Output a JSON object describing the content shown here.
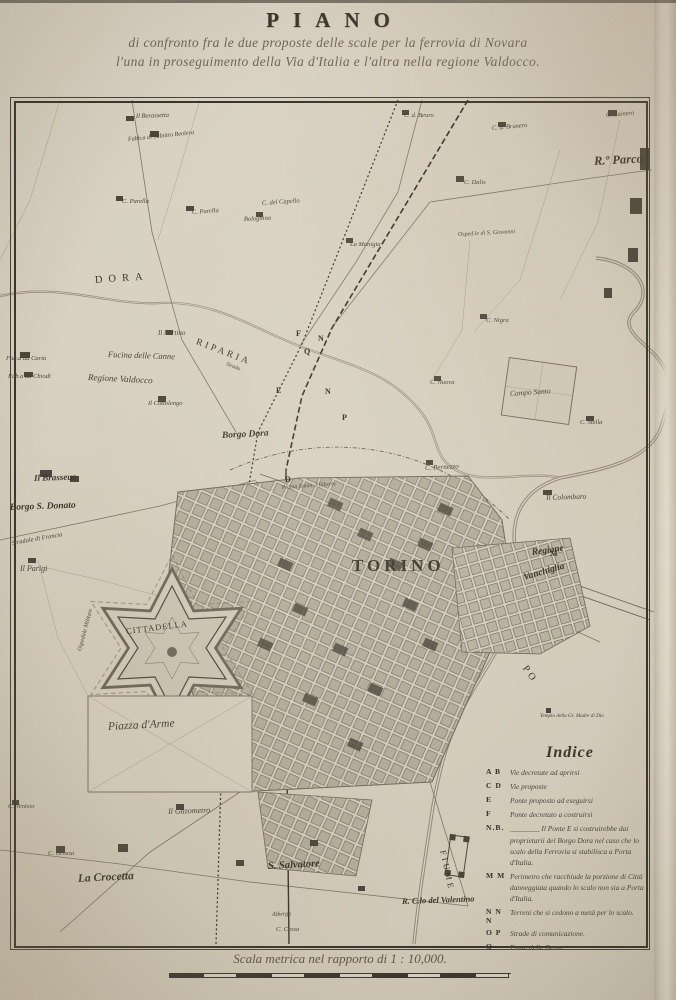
{
  "header": {
    "title": "PIANO",
    "subtitle1": "di confronto fra le due proposte delle scale per la ferrovia di Novara",
    "subtitle2": "l'una in proseguimento della Via d'Italia e l'altra nella regione Valdocco."
  },
  "map": {
    "city": "TORINO",
    "labels": [
      {
        "t": "DORA",
        "x": 95,
        "y": 276,
        "s": 10.5,
        "r": -4,
        "ls": 6,
        "c": "sp"
      },
      {
        "t": "RIPARIA",
        "x": 196,
        "y": 338,
        "s": 9.5,
        "r": 21,
        "ls": 3,
        "c": "sp"
      },
      {
        "t": "Fucina delle Canne",
        "x": 108,
        "y": 350,
        "s": 8.5,
        "r": 2,
        "c": "it"
      },
      {
        "t": "Regione Valdocco",
        "x": 88,
        "y": 373,
        "s": 9,
        "r": 3,
        "c": "it"
      },
      {
        "t": "Il Fortino",
        "x": 158,
        "y": 330,
        "s": 7,
        "c": "it"
      },
      {
        "t": "Fab.a da Carta",
        "x": 6,
        "y": 356,
        "s": 6.5,
        "c": "it"
      },
      {
        "t": "Fab.a da Chiodi",
        "x": 8,
        "y": 374,
        "s": 6.5,
        "c": "it"
      },
      {
        "t": "Borgo Dora",
        "x": 222,
        "y": 432,
        "s": 9.5,
        "r": -3,
        "c": "bd"
      },
      {
        "t": "Il Brasseur",
        "x": 34,
        "y": 474,
        "s": 9,
        "r": -2,
        "c": "bd"
      },
      {
        "t": "Borgo S. Donato",
        "x": 10,
        "y": 504,
        "s": 9.5,
        "r": -2,
        "c": "bd"
      },
      {
        "t": "Stradale di Francia",
        "x": 12,
        "y": 541,
        "s": 6.5,
        "r": -10,
        "c": "it"
      },
      {
        "t": "Il Parigi",
        "x": 20,
        "y": 565,
        "s": 8,
        "c": "it"
      },
      {
        "t": "Ospedale Militare",
        "x": 80,
        "y": 648,
        "s": 6,
        "r": -75,
        "c": "it"
      },
      {
        "t": "TORINO",
        "x": 352,
        "y": 557,
        "s": 17,
        "ls": 4,
        "c": "sp bd"
      },
      {
        "t": "Regione",
        "x": 532,
        "y": 549,
        "s": 9.5,
        "r": -8,
        "c": "bd"
      },
      {
        "t": "Vanchiglia",
        "x": 524,
        "y": 574,
        "s": 9.5,
        "r": -16,
        "c": "bd"
      },
      {
        "t": "R.º Parco",
        "x": 594,
        "y": 155,
        "s": 12.5,
        "r": -3,
        "c": "bd"
      },
      {
        "t": "C. Rainero",
        "x": 606,
        "y": 113,
        "s": 6.5,
        "r": -5,
        "c": "it"
      },
      {
        "t": "C. d. Brunero",
        "x": 492,
        "y": 126,
        "s": 6.5,
        "r": -5,
        "c": "it"
      },
      {
        "t": "Osped.le di S. Giovanni",
        "x": 458,
        "y": 232,
        "s": 6,
        "r": -3,
        "c": "it"
      },
      {
        "t": "C. d. Beuro",
        "x": 404,
        "y": 113,
        "s": 6.5,
        "c": "it"
      },
      {
        "t": "C. Dalis",
        "x": 464,
        "y": 180,
        "s": 6.5,
        "c": "it"
      },
      {
        "t": "La Manigia",
        "x": 350,
        "y": 242,
        "s": 6.5,
        "c": "it"
      },
      {
        "t": "C. Nigra",
        "x": 486,
        "y": 318,
        "s": 6.5,
        "c": "it"
      },
      {
        "t": "Campo Santo",
        "x": 510,
        "y": 390,
        "s": 7.5,
        "r": -4,
        "c": "it"
      },
      {
        "t": "C. Nuova",
        "x": 430,
        "y": 380,
        "s": 6.5,
        "c": "it"
      },
      {
        "t": "C. Stella",
        "x": 580,
        "y": 420,
        "s": 6.5,
        "c": "it"
      },
      {
        "t": "C. Bernezzo",
        "x": 425,
        "y": 465,
        "s": 7,
        "r": -3,
        "c": "it"
      },
      {
        "t": "Il Colombaro",
        "x": 546,
        "y": 494,
        "s": 7.5,
        "r": -2,
        "c": "it"
      },
      {
        "t": "Il Berassetto",
        "x": 136,
        "y": 114,
        "s": 6.5,
        "r": -2,
        "c": "it"
      },
      {
        "t": "Fabb.a di Salnitro Beolera",
        "x": 128,
        "y": 137,
        "s": 6.2,
        "r": -6,
        "c": "it"
      },
      {
        "t": "C. Parella",
        "x": 122,
        "y": 199,
        "s": 6.5,
        "c": "it"
      },
      {
        "t": "C. Parella",
        "x": 192,
        "y": 210,
        "s": 6.5,
        "r": -4,
        "c": "it"
      },
      {
        "t": "C. del Capello",
        "x": 262,
        "y": 201,
        "s": 6.5,
        "r": -4,
        "c": "it"
      },
      {
        "t": "Bolognina",
        "x": 244,
        "y": 217,
        "s": 6.5,
        "r": -3,
        "c": "it"
      },
      {
        "t": "Il Cottolengo",
        "x": 148,
        "y": 401,
        "s": 6.5,
        "c": "it"
      },
      {
        "t": "Piazza Eman. Filiberto",
        "x": 282,
        "y": 486,
        "s": 5.8,
        "r": -4,
        "c": "it"
      },
      {
        "t": "CITTADELLA",
        "x": 126,
        "y": 627,
        "s": 8.5,
        "r": -7,
        "ls": 1,
        "c": "sp"
      },
      {
        "t": "Piazza d'Arme",
        "x": 108,
        "y": 722,
        "s": 11.5,
        "r": -3,
        "c": "it"
      },
      {
        "t": "La Crocetta",
        "x": 78,
        "y": 874,
        "s": 11.5,
        "r": -3,
        "c": "bd"
      },
      {
        "t": "C. Grossa",
        "x": 48,
        "y": 851,
        "s": 6.5,
        "c": "it"
      },
      {
        "t": "Il Gazometro",
        "x": 168,
        "y": 808,
        "s": 8,
        "r": -2,
        "c": "it"
      },
      {
        "t": "C. Venisio",
        "x": 8,
        "y": 804,
        "s": 6.5,
        "c": "it"
      },
      {
        "t": "S. Salvatore",
        "x": 268,
        "y": 862,
        "s": 10.5,
        "r": -3,
        "c": "bd"
      },
      {
        "t": "Albergo",
        "x": 272,
        "y": 912,
        "s": 6,
        "r": -2,
        "c": "it"
      },
      {
        "t": "C. Crosa",
        "x": 276,
        "y": 927,
        "s": 6.5,
        "c": "it"
      },
      {
        "t": "R. C.lo del Valentino",
        "x": 402,
        "y": 897,
        "s": 8.5,
        "r": -2,
        "c": "bd"
      },
      {
        "t": "PO",
        "x": 524,
        "y": 662,
        "s": 10,
        "r": 55,
        "ls": 3,
        "c": "sp"
      },
      {
        "t": "FIUME",
        "x": 443,
        "y": 846,
        "s": 8.5,
        "r": 78,
        "ls": 3,
        "c": "sp"
      },
      {
        "t": "Tempio della Gr. Madre di Dio",
        "x": 540,
        "y": 714,
        "s": 5.2,
        "c": "it"
      },
      {
        "t": "Strada",
        "x": 226,
        "y": 362,
        "s": 5.5,
        "r": 22,
        "c": "it"
      }
    ],
    "letters": [
      {
        "t": "F",
        "x": 296,
        "y": 330
      },
      {
        "t": "Q",
        "x": 304,
        "y": 348
      },
      {
        "t": "E",
        "x": 276,
        "y": 387
      },
      {
        "t": "N",
        "x": 325,
        "y": 388
      },
      {
        "t": "P",
        "x": 342,
        "y": 414
      },
      {
        "t": "D",
        "x": 285,
        "y": 476
      },
      {
        "t": "N",
        "x": 318,
        "y": 335
      },
      {
        "t": "M",
        "x": 550,
        "y": 550
      }
    ]
  },
  "legend": {
    "title": "Indice",
    "items": [
      {
        "k": "A B",
        "t": "Vie decretate ad aprirsi"
      },
      {
        "k": "C D",
        "t": "Vie proposte"
      },
      {
        "k": "E",
        "t": "Ponte proposto ad eseguirsi"
      },
      {
        "k": "F",
        "t": "Ponte decretato a costruirsi"
      },
      {
        "k": "N.B.",
        "t": "________ Il Ponte E si costruirebbe dai proprietarii del Borgo Dora nel caso che lo scalo della Ferrovia si stabilisca a Porta d'Italia."
      },
      {
        "k": "M M",
        "t": "Perimetro che racchiude la porzione di Città danneggiata quando lo scalo non sia a Porta d'Italia."
      },
      {
        "k": "N N N",
        "t": "Terreni che si cedono a metà per lo scalo."
      },
      {
        "k": "O P",
        "t": "Strade di comunicazione."
      },
      {
        "k": "Q",
        "t": "Ponte delle Benne."
      }
    ]
  },
  "scale": {
    "caption": "Scala metrica nel rapporto di 1 : 10,000.",
    "segments": 10
  },
  "colors": {
    "paper": "#d6cfbf",
    "ink": "#38332b",
    "cursive_ink": "#4b4437",
    "river": "#93897a",
    "block_fill": "#b3ac9b",
    "dark_block": "#4b453b"
  }
}
